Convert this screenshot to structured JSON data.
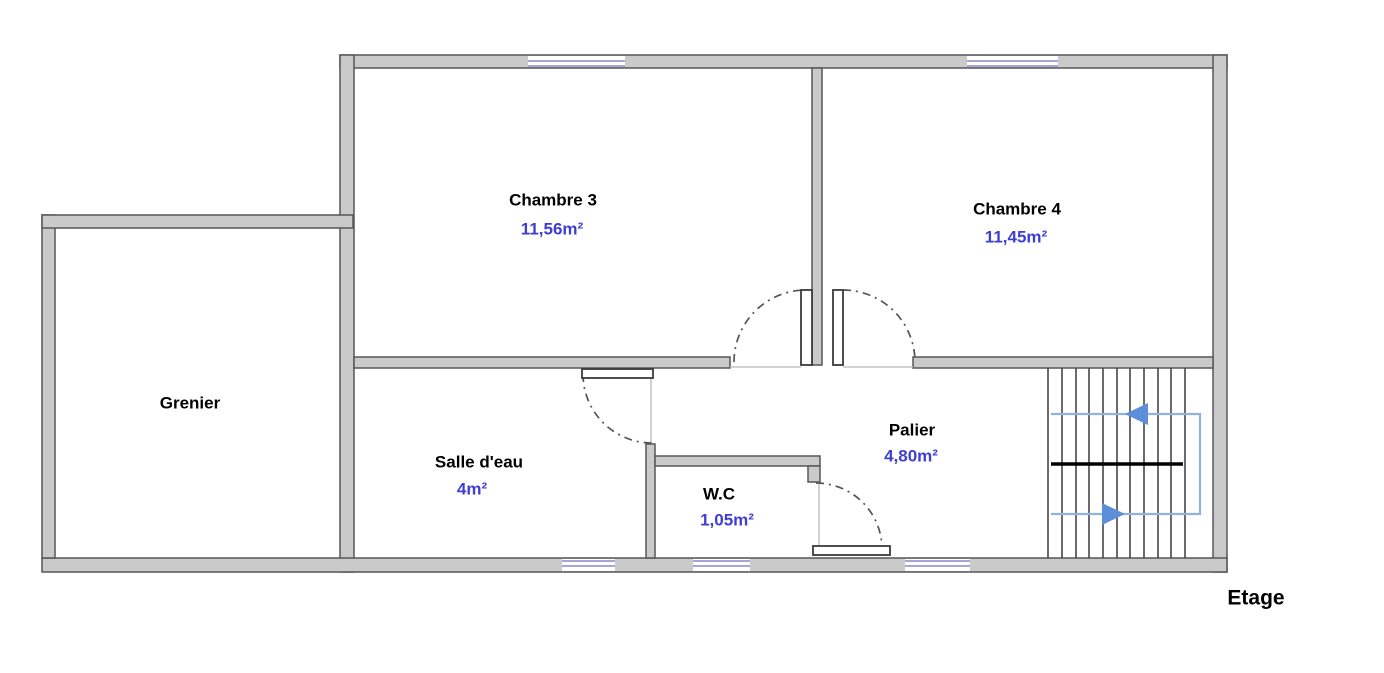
{
  "floor_plan": {
    "floor_label": "Etage",
    "rooms": [
      {
        "name": "Chambre 3",
        "area": "11,56m²"
      },
      {
        "name": "Chambre 4",
        "area": "11,45m²"
      },
      {
        "name": "Grenier",
        "area": ""
      },
      {
        "name": "Salle d'eau",
        "area": "4m²"
      },
      {
        "name": "W.C",
        "area": "1,05m²"
      },
      {
        "name": "Palier",
        "area": "4,80m²"
      }
    ],
    "colors": {
      "wall_fill": "#cacaca",
      "wall_stroke": "#565656",
      "door_fill": "#ffffff",
      "door_stroke": "#3a3a3a",
      "window_line": "#8787cc",
      "thin_line": "#b8b8b8",
      "tread_line": "#464646",
      "stair_mid_line": "#000000",
      "route_line": "#8fb2e2",
      "arrow_fill": "#5d8ed9",
      "room_text": "#000000",
      "area_text": "#3e3ed2"
    },
    "geometry": {
      "walls": [
        {
          "name": "wall-top-exterior",
          "r": [
            340,
            55,
            887,
            13
          ]
        },
        {
          "name": "wall-left-vertical",
          "r": [
            340,
            55,
            14,
            517
          ]
        },
        {
          "name": "wall-right-exterior",
          "r": [
            1213,
            55,
            14,
            517
          ]
        },
        {
          "name": "wall-bottom-exterior",
          "r": [
            42,
            558,
            1185,
            14
          ]
        },
        {
          "name": "wall-grenier-left",
          "r": [
            42,
            215,
            13,
            343
          ]
        },
        {
          "name": "wall-grenier-top",
          "r": [
            42,
            215,
            311,
            13
          ]
        },
        {
          "name": "wall-mid-left-segment",
          "r": [
            354,
            357,
            376,
            11
          ]
        },
        {
          "name": "wall-mid-right-segment",
          "r": [
            913,
            357,
            300,
            11
          ]
        },
        {
          "name": "wall-chambre-divider",
          "r": [
            812,
            68,
            10,
            297
          ]
        },
        {
          "name": "wall-salledeau-wc-divider",
          "r": [
            646,
            444,
            9,
            114
          ]
        },
        {
          "name": "wall-wc-top",
          "r": [
            655,
            456,
            165,
            10
          ]
        },
        {
          "name": "wall-wc-top-jamb",
          "r": [
            808,
            466,
            12,
            16
          ]
        }
      ],
      "window_gaps": [
        {
          "name": "window-gap-chambre3",
          "r": [
            528,
            56,
            97,
            11
          ]
        },
        {
          "name": "window-gap-chambre4",
          "r": [
            967,
            56,
            91,
            11
          ]
        },
        {
          "name": "window-gap-salledeau",
          "r": [
            562,
            559,
            53,
            12
          ]
        },
        {
          "name": "window-gap-wc",
          "r": [
            693,
            559,
            57,
            12
          ]
        },
        {
          "name": "window-gap-palier",
          "r": [
            905,
            559,
            65,
            12
          ]
        }
      ],
      "window_lines": [
        {
          "name": "window-chambre3-line",
          "l": [
            528,
            61,
            625,
            61
          ]
        },
        {
          "name": "window-chambre3-line",
          "l": [
            528,
            66,
            625,
            66
          ]
        },
        {
          "name": "window-chambre4-line",
          "l": [
            967,
            61,
            1058,
            61
          ]
        },
        {
          "name": "window-chambre4-line",
          "l": [
            967,
            66,
            1058,
            66
          ]
        },
        {
          "name": "window-salledeau-line",
          "l": [
            562,
            561,
            615,
            561
          ]
        },
        {
          "name": "window-salledeau-line",
          "l": [
            562,
            566,
            615,
            566
          ]
        },
        {
          "name": "window-wc-line",
          "l": [
            693,
            561,
            750,
            561
          ]
        },
        {
          "name": "window-wc-line",
          "l": [
            693,
            566,
            750,
            566
          ]
        },
        {
          "name": "window-palier-line",
          "l": [
            905,
            561,
            970,
            561
          ]
        },
        {
          "name": "window-palier-line",
          "l": [
            905,
            566,
            970,
            566
          ]
        }
      ],
      "door_leaves": [
        {
          "name": "door-leaf-chambre3",
          "r": [
            801,
            290,
            11,
            75
          ]
        },
        {
          "name": "door-leaf-chambre4",
          "r": [
            833,
            290,
            10,
            75
          ]
        },
        {
          "name": "door-leaf-salledeau",
          "r": [
            582,
            369,
            71,
            9
          ]
        },
        {
          "name": "door-leaf-wc",
          "r": [
            813,
            546,
            77,
            9
          ]
        }
      ],
      "thin_lines": [
        {
          "name": "door-closed-line-salledeau",
          "l": [
            651,
            378,
            651,
            444
          ]
        },
        {
          "name": "door-closed-line-wc",
          "l": [
            819,
            482,
            819,
            546
          ]
        },
        {
          "name": "door-threshold-chambre3",
          "l": [
            730,
            367,
            801,
            367
          ]
        },
        {
          "name": "door-threshold-chambre4",
          "l": [
            843,
            367,
            913,
            367
          ]
        }
      ],
      "door_arcs": [
        {
          "name": "door-arc-chambre3",
          "d": "M 734 362 A 72 72 0 0 1 806 290"
        },
        {
          "name": "door-arc-chambre4",
          "d": "M 843 290 A 72 72 0 0 1 915 362"
        },
        {
          "name": "door-arc-salledeau",
          "d": "M 583 374 A 69 69 0 0 0 652 443"
        },
        {
          "name": "door-arc-wc",
          "d": "M 816 483 A 66 66 0 0 1 882 549"
        }
      ],
      "stair_treads": [
        {
          "name": "stair-tread",
          "l": [
            1048,
            368,
            1048,
            558
          ]
        },
        {
          "name": "stair-tread",
          "l": [
            1062,
            368,
            1062,
            558
          ]
        },
        {
          "name": "stair-tread",
          "l": [
            1076,
            368,
            1076,
            558
          ]
        },
        {
          "name": "stair-tread",
          "l": [
            1089,
            368,
            1089,
            558
          ]
        },
        {
          "name": "stair-tread",
          "l": [
            1103,
            368,
            1103,
            558
          ]
        },
        {
          "name": "stair-tread",
          "l": [
            1117,
            368,
            1117,
            558
          ]
        },
        {
          "name": "stair-tread",
          "l": [
            1130,
            368,
            1130,
            558
          ]
        },
        {
          "name": "stair-tread",
          "l": [
            1144,
            368,
            1144,
            558
          ]
        },
        {
          "name": "stair-tread",
          "l": [
            1158,
            368,
            1158,
            558
          ]
        },
        {
          "name": "stair-tread",
          "l": [
            1171,
            368,
            1171,
            558
          ]
        },
        {
          "name": "stair-tread",
          "l": [
            1185,
            368,
            1185,
            558
          ]
        }
      ],
      "stair_mid_line": {
        "name": "stair-landing-line",
        "l": [
          1051,
          464,
          1183,
          464
        ]
      },
      "stair_route": {
        "name": "stair-route-path",
        "d": "M 1051 414 L 1200 414 L 1200 514 L 1051 514"
      },
      "stair_arrows": [
        {
          "name": "stair-arrow-up",
          "points": "1125,414 1148,403 1148,425"
        },
        {
          "name": "stair-arrow-down",
          "points": "1125,514 1102,503 1102,525"
        }
      ]
    }
  }
}
